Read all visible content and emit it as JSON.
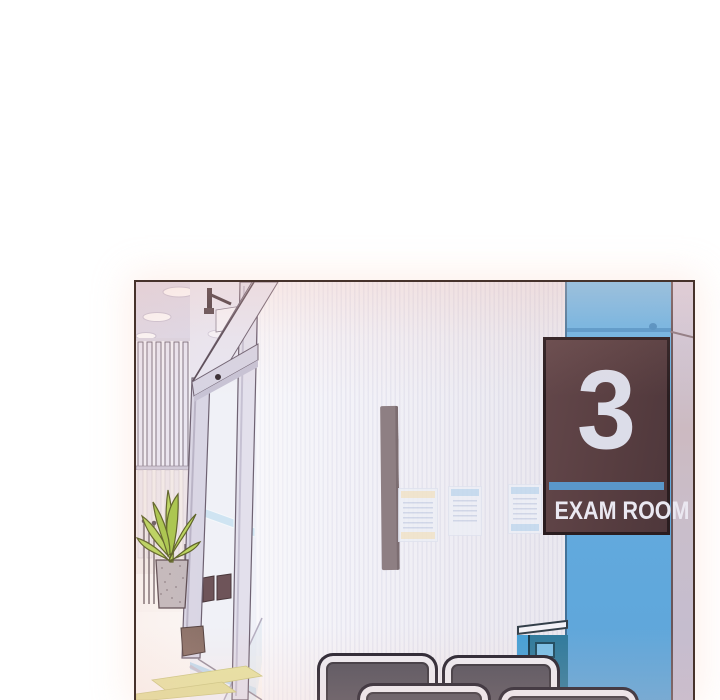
{
  "panel": {
    "description": "Webtoon panel of a clinic hallway: automatic glass entrance door with potted plant, white pin-striped wall, blue pillar bearing the exam room sign, waiting chairs and yellow floor mats",
    "border_color": "#46322b"
  },
  "sign": {
    "number": "3",
    "label": "EXAM ROOM",
    "background": "#583e41",
    "stripe_color": "#5a97ca",
    "text_color": "#eae8f1"
  },
  "colors": {
    "pillar_blue": "#66aede",
    "wall_stripe": "#e8e7f1",
    "ceiling": "#dcd9e9",
    "chair_gray": "#56535e",
    "plant_green": "#b9d45e",
    "mat_yellow": "#e6e2a2",
    "handle_bar": "#8e7f83",
    "cabinet_teal": "#2e7a9c"
  }
}
